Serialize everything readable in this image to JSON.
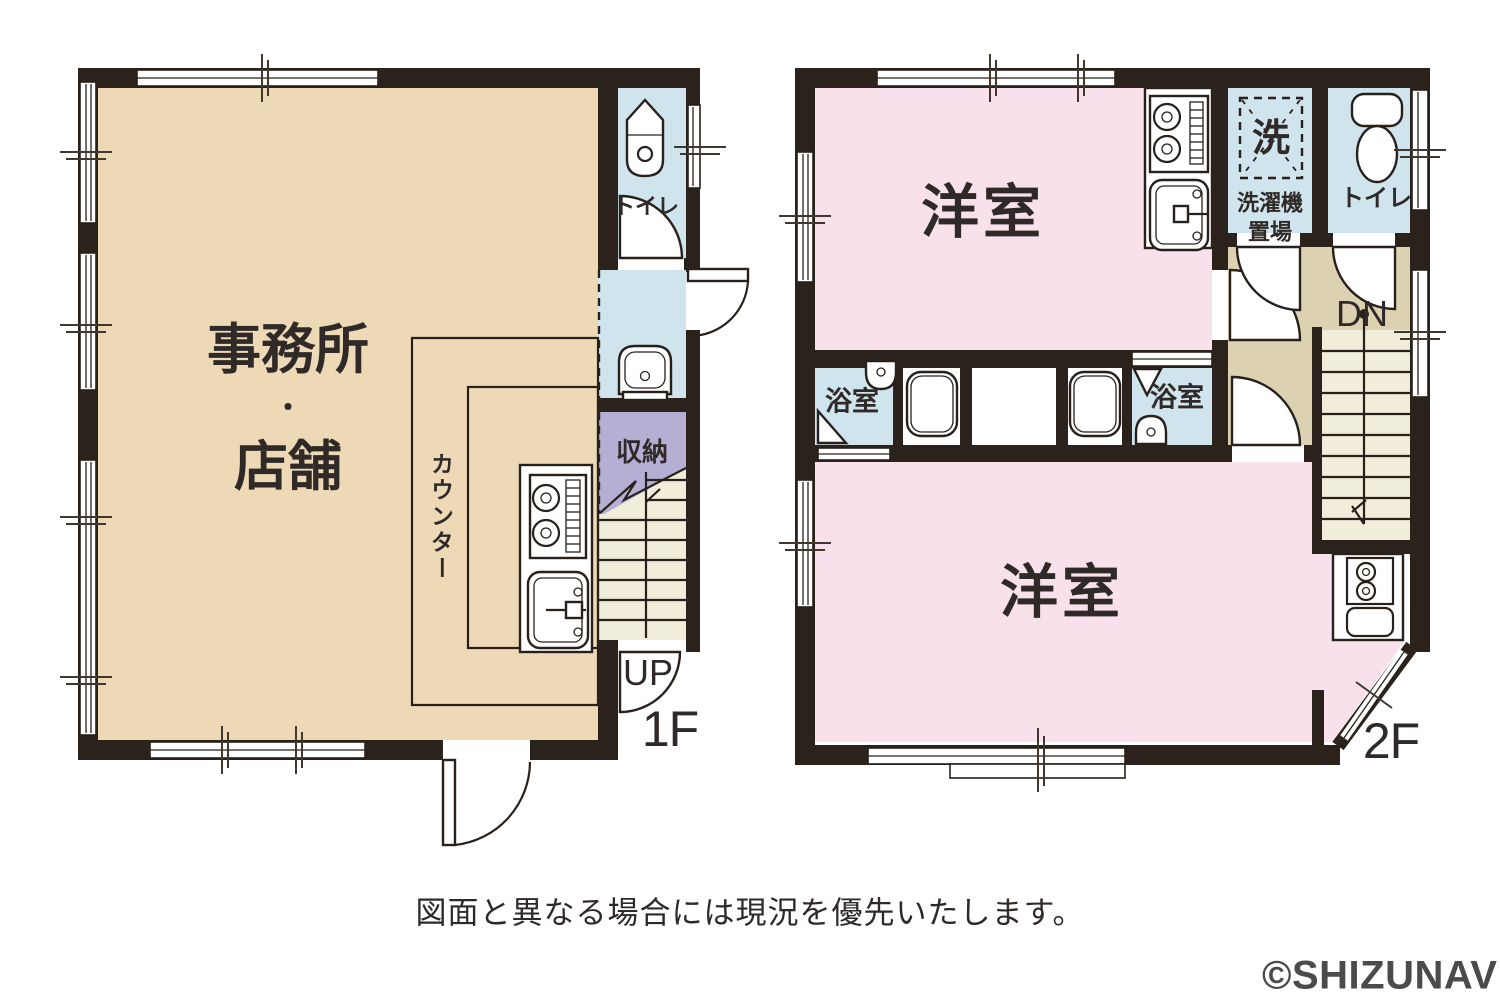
{
  "colors": {
    "wall": "#2b221c",
    "beige_room": "#eed9b6",
    "pink_room": "#f8e1eb",
    "wet_area_blue": "#d0e4ee",
    "storage_purple": "#b5afd3",
    "stair_cream": "#f0edda",
    "hall_tan": "#dcd2b2",
    "text": "#2f2a28",
    "watermark_gray": "#4b4b4b"
  },
  "floor1": {
    "floor_label": "1F",
    "office_shop_line1": "事務所",
    "office_shop_dot": "・",
    "office_shop_line2": "店舗",
    "counter_label": "カウンター",
    "toilet_label": "トイレ",
    "storage_label": "収納",
    "stairs_up_label": "UP"
  },
  "floor2": {
    "floor_label": "2F",
    "western_room_top": "洋室",
    "western_room_bottom": "洋室",
    "bathroom_left_label": "浴室",
    "bathroom_right_label": "浴室",
    "washer_symbol": "洗",
    "washer_place_line1": "洗濯機",
    "washer_place_line2": "置場",
    "toilet_label": "トイレ",
    "stairs_down_label": "DN"
  },
  "footer": {
    "disclaimer": "図面と異なる場合には現況を優先いたします。"
  },
  "watermark": {
    "text": "©SHIZUNAVI"
  }
}
